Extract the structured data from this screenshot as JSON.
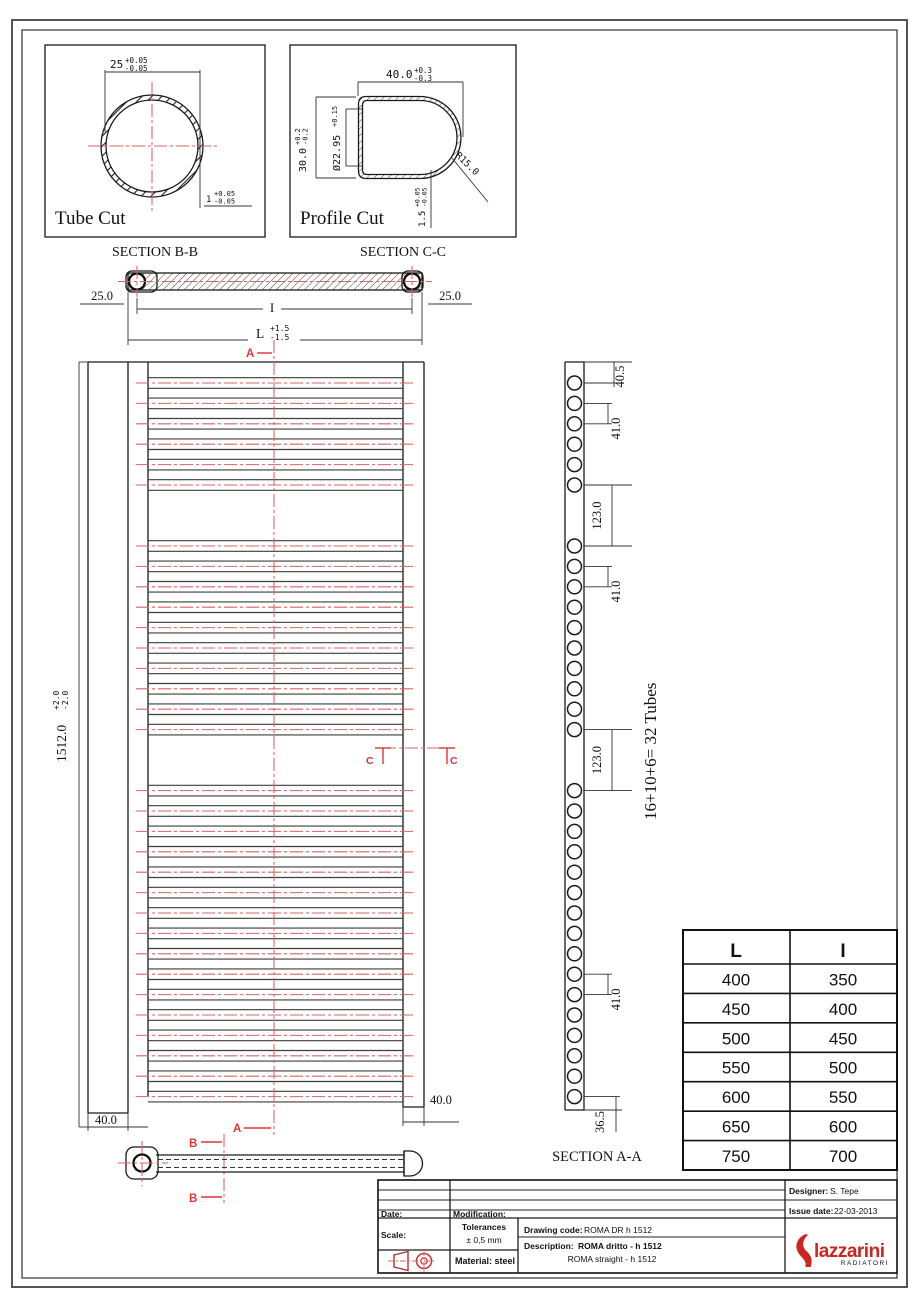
{
  "colors": {
    "red_line": "#dd6060",
    "red_marker": "#e03434",
    "logo_red": "#cc2620",
    "line": "#1a1a1a"
  },
  "tube_cut": {
    "title": "Tube Cut",
    "caption": "SECTION B-B",
    "dia": "25",
    "dia_tol_p": "+0.05",
    "dia_tol_m": "-0.05",
    "wall": "1",
    "wall_tol_p": "+0.05",
    "wall_tol_m": "-0.05"
  },
  "profile_cut": {
    "title": "Profile Cut",
    "caption": "SECTION C-C",
    "width": "40.0",
    "width_tol_p": "+0.3",
    "width_tol_m": "-0.3",
    "height": "30.0",
    "height_tol_p": "+0.2",
    "height_tol_m": "-0.2",
    "bore": "Ø22.95",
    "bore_tol": "+0.15",
    "radius": "R15.0",
    "wall": "1.5",
    "wall_tol_p": "+0.05",
    "wall_tol_m": "-0.05"
  },
  "plan": {
    "offset_left": "25.0",
    "offset_right": "25.0",
    "inner_dim": "I",
    "length_dim": "L",
    "length_tol_p": "+1.5",
    "length_tol_m": "-1.5"
  },
  "front": {
    "height": "1512.0",
    "height_tol_p": "+2.0",
    "height_tol_m": "-2.0",
    "bottom_left": "40.0",
    "bottom_right": "40.0"
  },
  "markers": {
    "a": "A",
    "b": "B",
    "c": "C"
  },
  "section_aa": {
    "caption": "SECTION A-A",
    "note": "16+10+6= 32 Tubes",
    "groups": [
      6,
      10,
      16
    ],
    "dim_top": "40.5",
    "dim_pitch": "41.0",
    "dim_gap": "123.0",
    "dim_bottom": "36.5"
  },
  "size_table": {
    "col1": "L",
    "col2": "I",
    "rows": [
      [
        "400",
        "350"
      ],
      [
        "450",
        "400"
      ],
      [
        "500",
        "450"
      ],
      [
        "550",
        "500"
      ],
      [
        "600",
        "550"
      ],
      [
        "650",
        "600"
      ],
      [
        "750",
        "700"
      ]
    ]
  },
  "title_block": {
    "date_label": "Date:",
    "modification_label": "Modification:",
    "scale_label": "Scale:",
    "tolerances_label": "Tolerances",
    "tolerances_value": "± 0,5 mm",
    "material": "Material: steel",
    "drawing_code_label": "Drawing code:",
    "drawing_code": "ROMA DR h 1512",
    "description_label": "Description:",
    "description_bold": "ROMA dritto - h 1512",
    "description_alt": "ROMA straight - h 1512",
    "designer_label": "Designer:",
    "designer": "S. Tepe",
    "issue_label": "Issue date:",
    "issue_date": "22-03-2013",
    "brand": "lazzarini",
    "brand_sub": "RADIATORI"
  }
}
